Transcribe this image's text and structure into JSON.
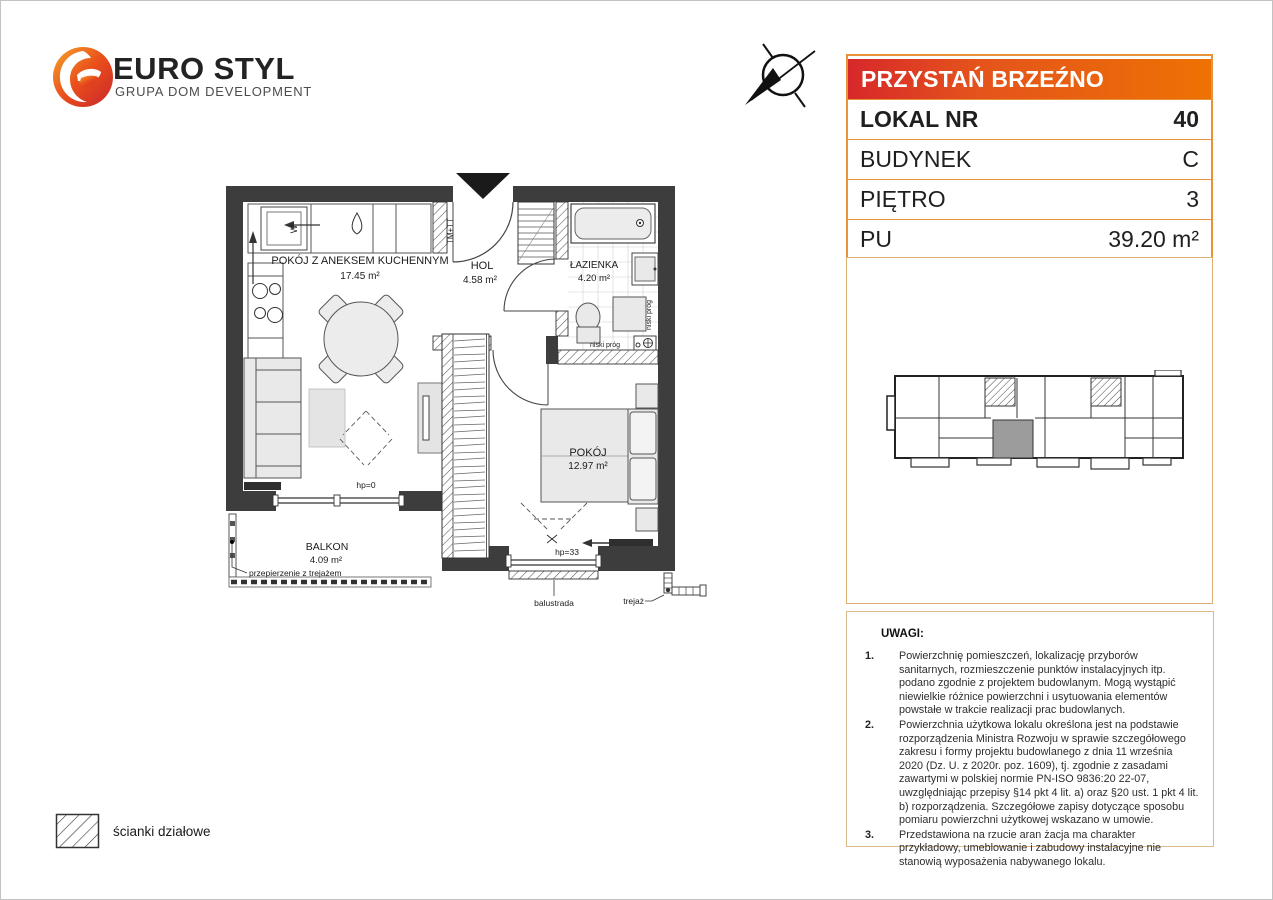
{
  "brand": {
    "name": "EURO STYL",
    "tagline": "GRUPA DOM DEVELOPMENT"
  },
  "header": {
    "project_name": "PRZYSTAŃ BRZEŹNO"
  },
  "unit_table": {
    "rows": [
      {
        "label": "LOKAL NR",
        "value": "40"
      },
      {
        "label": "BUDYNEK",
        "value": "C"
      },
      {
        "label": "PIĘTRO",
        "value": "3"
      },
      {
        "label": "PU",
        "value": "39.20 m²"
      }
    ]
  },
  "floor_plan": {
    "rooms": [
      {
        "name": "POKÓJ Z ANEKSEM KUCHENNYM",
        "area": "17.45 m²"
      },
      {
        "name": "HOL",
        "area": "4.58 m²"
      },
      {
        "name": "ŁAZIENKA",
        "area": "4.20 m²"
      },
      {
        "name": "POKÓJ",
        "area": "12.97 m²"
      },
      {
        "name": "BALKON",
        "area": "4.09 m²"
      }
    ],
    "annotations": {
      "shaft": "TM+TT",
      "washer": "W",
      "low_threshold_vertical": "niski próg",
      "low_threshold_horizontal": "niski próg",
      "hp_zero": "hp=0",
      "hp_33": "hp=33",
      "balustrade": "balustrada",
      "trellis": "trejaż",
      "partition_trellis": "przepierzenie z trejażem"
    }
  },
  "legend": {
    "partition_walls": "ścianki działowe"
  },
  "notes": {
    "title": "UWAGI:",
    "items": [
      {
        "num": "1.",
        "text": "Powierzchnię pomieszczeń, lokalizację przyborów sanitarnych, rozmieszczenie punktów instalacyjnych itp. podano zgodnie z projektem budowlanym. Mogą wystąpić niewielkie różnice powierzchni i usytuowania elementów powstałe w trakcie realizacji prac budowlanych."
      },
      {
        "num": "2.",
        "text": "Powierzchnia użytkowa lokalu określona jest na podstawie rozporządzenia Ministra Rozwoju w sprawie szczegółowego zakresu i formy projektu budowlanego z dnia 11 września 2020 (Dz. U. z 2020r. poz. 1609), tj. zgodnie z zasadami zawartymi w polskiej normie PN-ISO 9836:20 22-07, uwzględniając przepisy §14 pkt 4 lit. a) oraz §20 ust. 1 pkt 4 lit. b) rozporządzenia. Szczegółowe zapisy dotyczące sposobu pomiaru powierzchni użytkowej wskazano w umowie."
      },
      {
        "num": "3.",
        "text": "Przedstawiona na rzucie aran żacja ma charakter przykładowy, umeblowanie i zabudowy instalacyjne nie stanowią wyposażenia nabywanego lokalu."
      }
    ]
  }
}
